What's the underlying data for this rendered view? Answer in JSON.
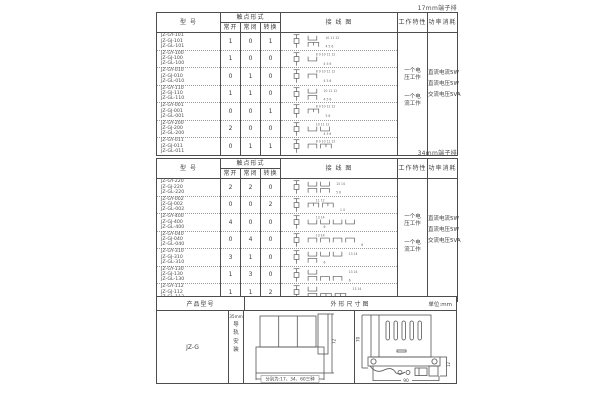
{
  "table17": {
    "corner_label": "17mm端子排",
    "headers": {
      "model": "型 号",
      "contact_form": "触点形式",
      "no": "常开",
      "nc": "常闭",
      "co": "转换",
      "wiring": "接 线 图",
      "work": "工作特性",
      "power": "功率消耗"
    },
    "rows": [
      {
        "models": [
          "JZ-GY-101",
          "JZ-GJ-101",
          "JZ-GL-101"
        ],
        "no": 1,
        "nc": 0,
        "co": 1,
        "pins_top": "10 11 12",
        "pins_bottom": "4 5 6"
      },
      {
        "models": [
          "JZ-GY-100",
          "JZ-GJ-100",
          "JZ-GL-100"
        ],
        "no": 1,
        "nc": 0,
        "co": 0,
        "pins_top": "8 9 10 11 12",
        "pins_bottom": "4 5 6"
      },
      {
        "models": [
          "JZ-GY-010",
          "JZ-GJ-010",
          "JZ-GL-010"
        ],
        "no": 0,
        "nc": 1,
        "co": 0,
        "pins_top": "8 9 10 11 12",
        "pins_bottom": "4 5 6"
      },
      {
        "models": [
          "JZ-GY-110",
          "JZ-GJ-110",
          "JZ-GL-110"
        ],
        "no": 1,
        "nc": 1,
        "co": 0,
        "pins_top": "10 11 12",
        "pins_bottom": "4 5 6"
      },
      {
        "models": [
          "JZ-GY-001",
          "JZ-GJ-001",
          "JZ-GL-001"
        ],
        "no": 0,
        "nc": 0,
        "co": 1,
        "pins_top": "8 9 10 11 12",
        "pins_bottom": "5 6"
      },
      {
        "models": [
          "JZ-GY-200",
          "JZ-GJ-200",
          "JZ-GL-200"
        ],
        "no": 2,
        "nc": 0,
        "co": 0,
        "pins_top": "10 11 12",
        "pins_bottom": "4 5 6"
      },
      {
        "models": [
          "JZ-GY-011",
          "JZ-GJ-011",
          "JZ-GL-011"
        ],
        "no": 0,
        "nc": 1,
        "co": 1,
        "pins_top": "8 9 10 11 12",
        "pins_bottom": ""
      }
    ],
    "work_groups": [
      {
        "line1": "一个电",
        "line2": "压工作"
      },
      {
        "line1": "一个电",
        "line2": "流工作"
      }
    ],
    "power_lines": [
      "直流电流5W",
      "直流电压5W",
      "交流电压5VA"
    ]
  },
  "table34": {
    "corner_label": "34mm端子排",
    "headers": {
      "model": "型 号",
      "contact_form": "触点形式",
      "no": "常开",
      "nc": "常闭",
      "co": "转换",
      "wiring": "接 线 图",
      "work": "工作特性",
      "power": "功率消耗"
    },
    "rows": [
      {
        "models": [
          "JZ-GY-220",
          "JZ-GJ-220",
          "JZ-GL-220"
        ],
        "no": 2,
        "nc": 2,
        "co": 0,
        "pins_top": "13 14",
        "pins_bottom": "5 6"
      },
      {
        "models": [
          "JZ-GY-002",
          "JZ-GJ-002",
          "JZ-GL-002"
        ],
        "no": 0,
        "nc": 0,
        "co": 2,
        "pins_top": "11 12",
        "pins_bottom": "1 4"
      },
      {
        "models": [
          "JZ-GY-400",
          "JZ-GJ-400",
          "JZ-GL-400"
        ],
        "no": 4,
        "nc": 0,
        "co": 0,
        "pins_top": "13 14",
        "pins_bottom": "6"
      },
      {
        "models": [
          "JZ-GY-040",
          "JZ-GJ-040",
          "JZ-GL-040"
        ],
        "no": 0,
        "nc": 4,
        "co": 0,
        "pins_top": "13 14",
        "pins_bottom": "6"
      },
      {
        "models": [
          "JZ-GY-310",
          "JZ-GJ-310",
          "JZ-GL-310"
        ],
        "no": 3,
        "nc": 1,
        "co": 0,
        "pins_top": "13 14",
        "pins_bottom": "6"
      },
      {
        "models": [
          "JZ-GY-130",
          "JZ-GJ-130",
          "JZ-GL-130"
        ],
        "no": 1,
        "nc": 3,
        "co": 0,
        "pins_top": "13 14",
        "pins_bottom": "6"
      },
      {
        "models": [
          "JZ-GY-112",
          "JZ-GJ-112",
          "JZ-GL-112"
        ],
        "no": 1,
        "nc": 1,
        "co": 2,
        "pins_top": "13 14",
        "pins_bottom": ""
      }
    ],
    "work_groups": [
      {
        "line1": "一个电",
        "line2": "压工作"
      },
      {
        "line1": "一个电",
        "line2": "流工作"
      }
    ],
    "power_lines": [
      "直流电流5W",
      "直流电压5W",
      "交流电压5VA"
    ]
  },
  "outline": {
    "header_product": "产品型号",
    "header_drawing": "外形尺寸图",
    "header_unit": "单位:mm",
    "model": "JZ-G",
    "mount_size": "35mm",
    "mount_chars": [
      "导",
      "轨",
      "安",
      "装"
    ],
    "front_view": {
      "height_dim": "72",
      "width_note": "分别为:17、34、60三种"
    },
    "side_view": {
      "height_dim": "70",
      "width_dim": "90",
      "side_dim": "12"
    }
  },
  "colors": {
    "ink": "#3f3f3f",
    "line": "#4d4d4d",
    "dotted": "#9a9a9a",
    "diagram": "#555555"
  }
}
